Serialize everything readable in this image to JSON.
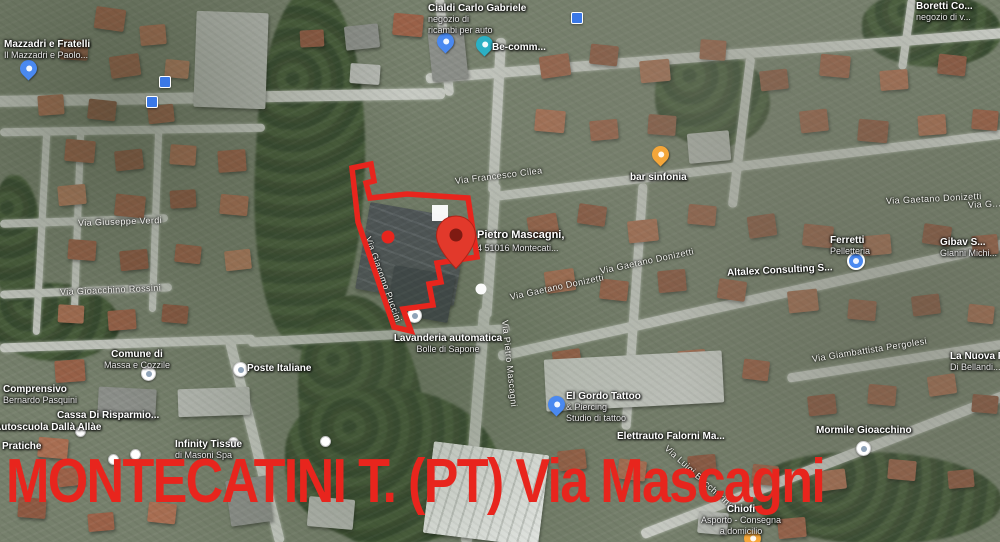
{
  "map": {
    "title_overlay": "MONTECATINI T. (PT) Via Mascagni",
    "overlay_color": "#e8251d",
    "selection": {
      "outline_points": "352,168 371,164 374,181 366,183 370,198 407,194 468,198 477,257 437,263 441,282 429,284 433,305 403,309 411,331 394,327 358,222",
      "pin": {
        "x": 456,
        "y": 243
      },
      "dot": {
        "x": 388,
        "y": 237
      },
      "white_square": {
        "x": 432,
        "y": 205
      },
      "white_circle": {
        "x": 481,
        "y": 289
      }
    },
    "pois": [
      {
        "id": "cialdi-carlo-gabriele",
        "x": 428,
        "y": 3,
        "lines": [
          "Cialdi Carlo Gabriele",
          "negozio di",
          "ricambi per auto"
        ],
        "pin": {
          "type": "tear",
          "color": "#4a89f0",
          "x": 437,
          "y": 33
        }
      },
      {
        "id": "be-comm",
        "x": 492,
        "y": 42,
        "lines": [
          "Be-comm..."
        ],
        "pin": {
          "type": "tear",
          "color": "#2bb0c4",
          "x": 476,
          "y": 36
        }
      },
      {
        "id": "boretti",
        "x": 916,
        "y": 1,
        "lines": [
          "Boretti Co...",
          "negozio di v..."
        ]
      },
      {
        "id": "mazzadri",
        "x": 4,
        "y": 39,
        "lines": [
          "Mazzadri e Fratelli",
          "Il Mazzadri e Paolo..."
        ],
        "pin": {
          "type": "tear",
          "color": "#4a89f0",
          "x": 20,
          "y": 60
        }
      },
      {
        "id": "bar-sinfonia",
        "x": 630,
        "y": 172,
        "lines": [
          "bar sinfonia"
        ],
        "pin": {
          "type": "tear",
          "color": "#f4a63a",
          "x": 652,
          "y": 146
        }
      },
      {
        "id": "address",
        "cls": "addr",
        "x": 477,
        "y": 229,
        "lines": [
          "Pietro Mascagni,",
          "4 51016 Montecati..."
        ]
      },
      {
        "id": "lavanderia",
        "center": true,
        "x": 448,
        "y": 333,
        "lines": [
          "Lavanderia automatica",
          "Bolle di Sapone"
        ],
        "pin": {
          "type": "circw",
          "x": 407,
          "y": 308
        }
      },
      {
        "id": "el-gordo-tattoo",
        "x": 566,
        "y": 391,
        "lines": [
          "El Gordo Tattoo",
          "& Piercing",
          "Studio di tattoo"
        ],
        "pin": {
          "type": "tear",
          "color": "#4a89f0",
          "x": 548,
          "y": 396
        }
      },
      {
        "id": "elettrauto-falorni",
        "x": 617,
        "y": 431,
        "lines": [
          "Elettrauto Falorni Ma..."
        ]
      },
      {
        "id": "ferretti",
        "x": 830,
        "y": 235,
        "lines": [
          "Ferretti",
          "Pelletteria"
        ],
        "pin": {
          "type": "circ",
          "color": "#4a89f0",
          "x": 847,
          "y": 252
        }
      },
      {
        "id": "gibav",
        "x": 940,
        "y": 237,
        "lines": [
          "Gibav S...",
          "Gianni Michi..."
        ]
      },
      {
        "id": "altalex",
        "x": 727,
        "y": 265,
        "rot": -3,
        "lines": [
          "Altalex Consulting S..."
        ]
      },
      {
        "id": "la-nuova",
        "x": 950,
        "y": 351,
        "lines": [
          "La Nuova P...",
          "Di Bellandi..."
        ]
      },
      {
        "id": "mormile-gioacchino",
        "x": 816,
        "y": 425,
        "lines": [
          "Mormile Gioacchino"
        ],
        "pin": {
          "type": "circw",
          "x": 856,
          "y": 441
        }
      },
      {
        "id": "comune-massa-cozzile",
        "center": true,
        "x": 137,
        "y": 349,
        "lines": [
          "Comune di",
          "Massa e Cozzile"
        ],
        "pin": {
          "type": "circw",
          "x": 141,
          "y": 366
        }
      },
      {
        "id": "poste-italiane",
        "x": 247,
        "y": 363,
        "lines": [
          "Poste Italiane"
        ],
        "pin": {
          "type": "circw",
          "x": 233,
          "y": 362
        }
      },
      {
        "id": "comprensivo-pasquini",
        "x": 3,
        "y": 384,
        "lines": [
          "Comprensivo",
          "Bernardo Pasquini"
        ]
      },
      {
        "id": "cassa-di-risparmio",
        "x": 57,
        "y": 410,
        "lines": [
          "Cassa Di Risparmio..."
        ]
      },
      {
        "id": "autoscuola",
        "x": -6,
        "y": 422,
        "lines": [
          "Autoscuola Dallà Allàe"
        ]
      },
      {
        "id": "pratiche",
        "x": 2,
        "y": 441,
        "lines": [
          "Pratiche"
        ]
      },
      {
        "id": "infinity-tissue",
        "x": 175,
        "y": 439,
        "lines": [
          "Infinity Tissue",
          "di Masoni Spa"
        ]
      },
      {
        "id": "chiofi",
        "center": true,
        "x": 741,
        "y": 504,
        "lines": [
          "Chiofi",
          "Asporto - Consegna",
          "a domicilio"
        ],
        "pin": {
          "type": "tear",
          "color": "#f4a63a",
          "x": 744,
          "y": 530
        }
      }
    ],
    "streets": [
      {
        "name": "Via Giuseppe Verdi",
        "x": 78,
        "y": 218,
        "rot": -2
      },
      {
        "name": "Via Gioacchino Rossini",
        "x": 60,
        "y": 287,
        "rot": -2.5
      },
      {
        "name": "Via Francesco Cilea",
        "x": 455,
        "y": 176,
        "rot": -7
      },
      {
        "name": "Via Gaetano Donizetti",
        "x": 510,
        "y": 292,
        "rot": -12
      },
      {
        "name": "Via Gaetano Donizetti",
        "x": 600,
        "y": 266,
        "rot": -12
      },
      {
        "name": "Via Gaetano Donizetti",
        "x": 886,
        "y": 196,
        "rot": -3
      },
      {
        "name": "Via G...",
        "x": 968,
        "y": 200,
        "rot": -3
      },
      {
        "name": "Via Pietro Mascagni",
        "x": 505,
        "y": 315,
        "rot": 84
      },
      {
        "name": "Via Giacomo Puccini",
        "x": 368,
        "y": 232,
        "rot": 70
      },
      {
        "name": "Via Giambattista Pergolesi",
        "x": 812,
        "y": 354,
        "rot": -9
      },
      {
        "name": "Via Luigi Boccherini",
        "x": 666,
        "y": 442,
        "rot": 42
      }
    ],
    "small_markers": [
      {
        "type": "sq",
        "x": 159,
        "y": 76
      },
      {
        "type": "sq",
        "x": 146,
        "y": 96
      },
      {
        "type": "sq",
        "x": 571,
        "y": 12
      },
      {
        "type": "dot",
        "x": 75,
        "y": 426
      },
      {
        "type": "dot",
        "x": 108,
        "y": 454
      },
      {
        "type": "dot",
        "x": 130,
        "y": 449
      },
      {
        "type": "dot",
        "x": 228,
        "y": 437
      },
      {
        "type": "dot",
        "x": 320,
        "y": 436
      }
    ]
  }
}
